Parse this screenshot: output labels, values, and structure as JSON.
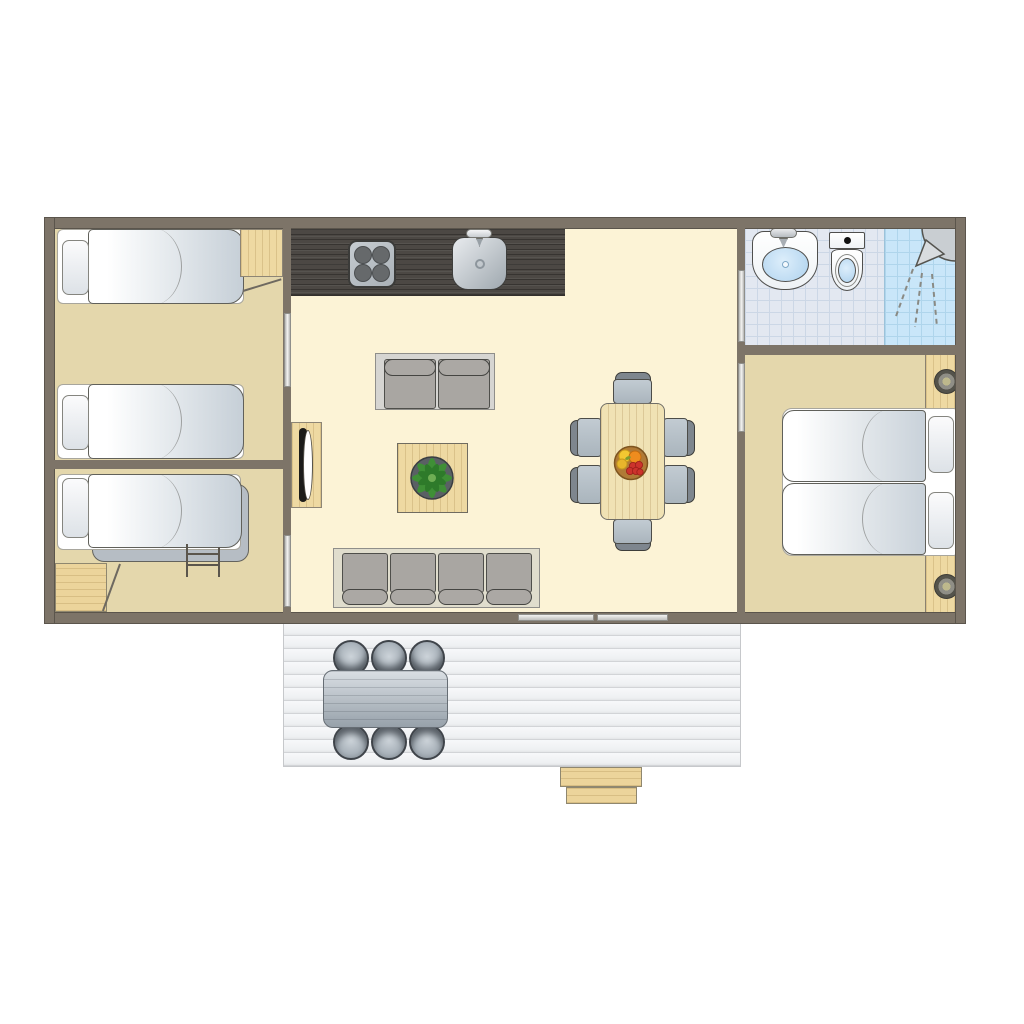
{
  "meta": {
    "type": "floor-plan",
    "view": "top-down",
    "description": "Holiday chalet / mobile-home floor plan with three bedrooms, bathroom, open living-kitchen area and front deck"
  },
  "palette": {
    "wall": "#7d7468",
    "bedroom_floor": "#e4d7ac",
    "living_floor": "#fcf3d6",
    "bathroom_tile": "#e3e8f1",
    "shower_tile": "#c9e6f9",
    "deck_plank": "#eef0f2",
    "wood_furniture": "#eed9a2",
    "kitchen_counter": "#4c4844",
    "sofa_cushion": "#a9a6a2",
    "chair_seat": "#b7c1c9",
    "mattress": "#e3e8ec",
    "fruit_red": "#cc332c",
    "fruit_orange": "#ee8c1e",
    "fruit_yellow": "#f2c832",
    "plant_green": "#3f8f36"
  },
  "rooms": [
    {
      "id": "bedroom-left-top",
      "label": "Bedroom with two single beds",
      "furniture": [
        "single-bed",
        "single-bed",
        "wooden-cabinet",
        "hinged-door"
      ],
      "bed_count": 2
    },
    {
      "id": "bedroom-left-bottom",
      "label": "Bedroom with bunk bed",
      "furniture": [
        "bunk-bed",
        "bunk-ladder",
        "wooden-cabinet",
        "hinged-door"
      ],
      "bed_count": 2
    },
    {
      "id": "living-kitchen",
      "label": "Open living room and kitchen",
      "furniture": [
        "kitchen-counter",
        "stove-4-burners",
        "kitchen-sink",
        "wardrobe",
        "two-seat-sofa",
        "coffee-table-with-plant",
        "dining-table-with-fruit-bowl",
        "six-dining-chairs",
        "four-seat-sofa"
      ],
      "dining_chair_count": 6,
      "stove_burner_count": 4
    },
    {
      "id": "bathroom",
      "label": "Bathroom with washbasin, toilet and shower",
      "furniture": [
        "washbasin",
        "toilet",
        "shower"
      ]
    },
    {
      "id": "bedroom-right",
      "label": "Master bedroom with double bed",
      "furniture": [
        "double-bed",
        "wood-headboard",
        "two-spotlights"
      ],
      "bed_count": 2
    },
    {
      "id": "deck",
      "label": "Outdoor deck with garden table and steps",
      "furniture": [
        "outdoor-table",
        "six-outdoor-chairs",
        "wooden-steps",
        "sliding-door"
      ],
      "outdoor_chair_count": 6
    }
  ],
  "doors": {
    "sliding_interior": 4,
    "hinged_interior": 2,
    "sliding_exterior": 1
  }
}
